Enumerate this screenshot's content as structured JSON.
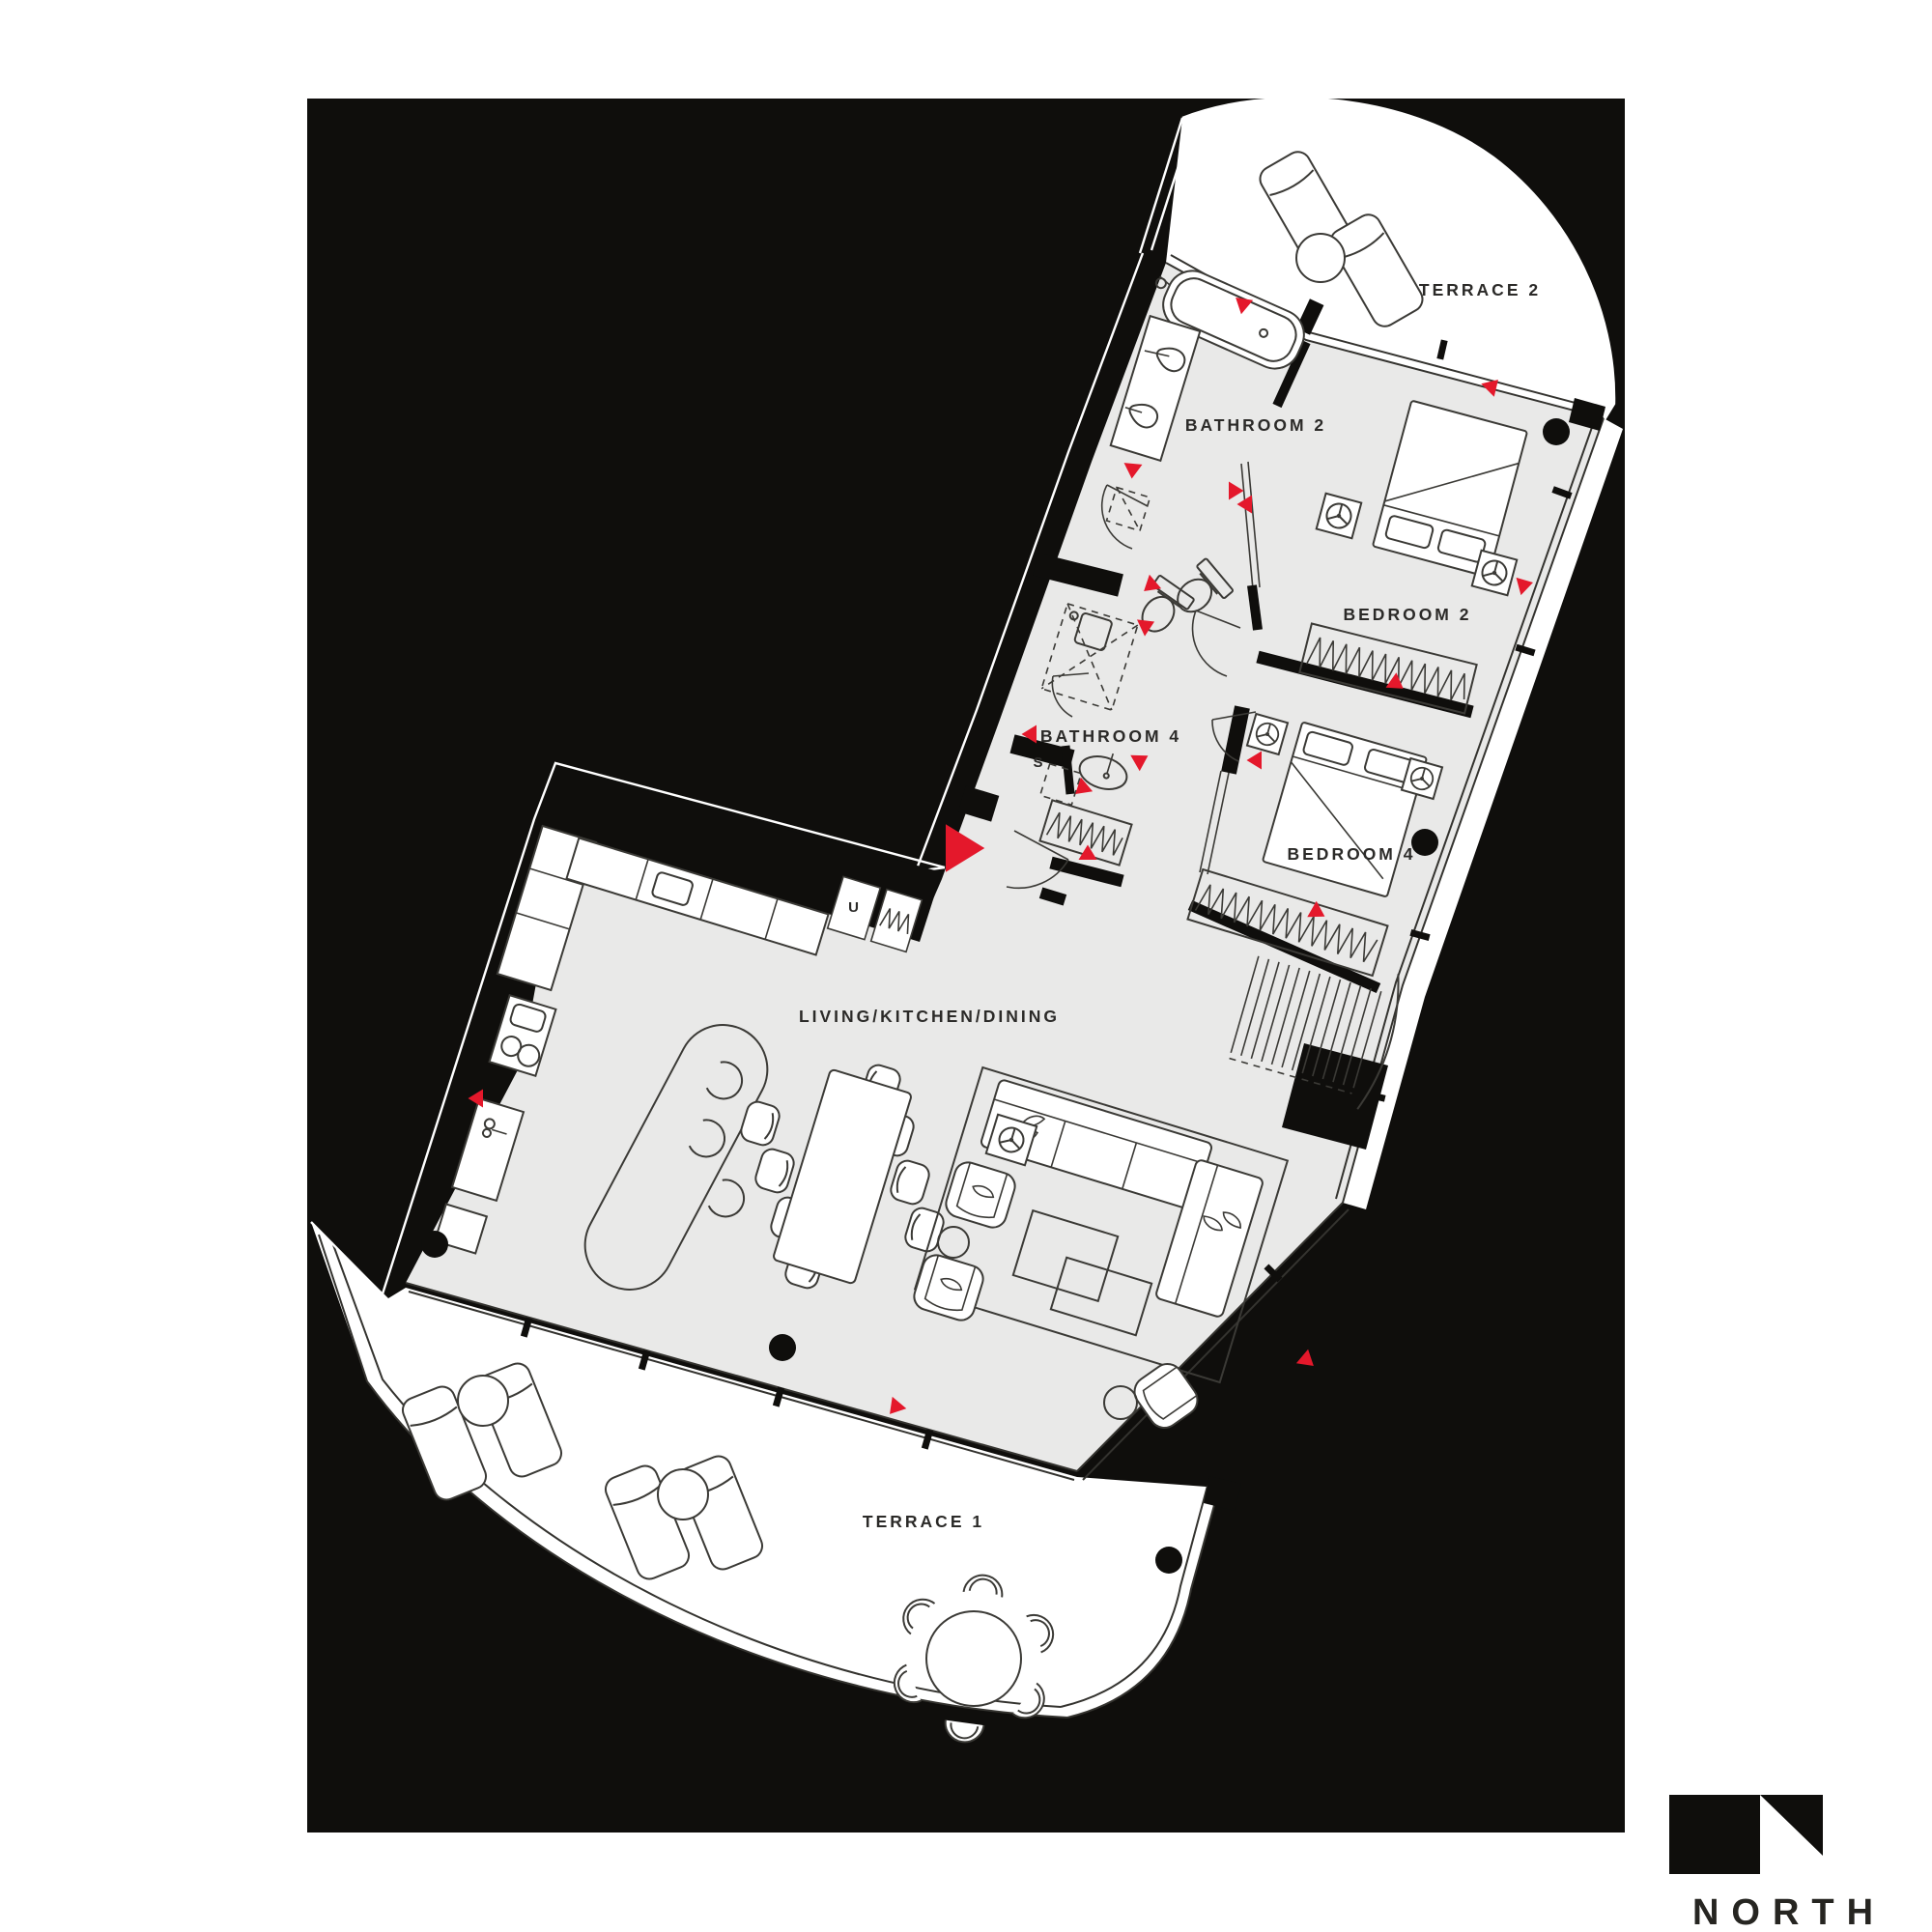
{
  "palette": {
    "board": "#0f0e0c",
    "floor": "#e9e9e8",
    "furniture_line": "#3b3a36",
    "glass_line": "#34332f",
    "marker_red": "#e4182b",
    "label": "#2b2a28",
    "terrace": "#ffffff"
  },
  "rooms": {
    "terrace2": {
      "label": "TERRACE 2"
    },
    "bathroom2": {
      "label": "BATHROOM 2"
    },
    "bedroom2": {
      "label": "BEDROOM 2"
    },
    "bathroom4": {
      "label": "BATHROOM 4"
    },
    "storage": {
      "label": "S"
    },
    "bedroom4": {
      "label": "BEDROOM 4"
    },
    "living": {
      "label": "LIVING/KITCHEN/DINING"
    },
    "utility": {
      "label": "U"
    },
    "terrace1": {
      "label": "TERRACE 1"
    }
  },
  "branding": {
    "logo_text": "NORTH"
  }
}
